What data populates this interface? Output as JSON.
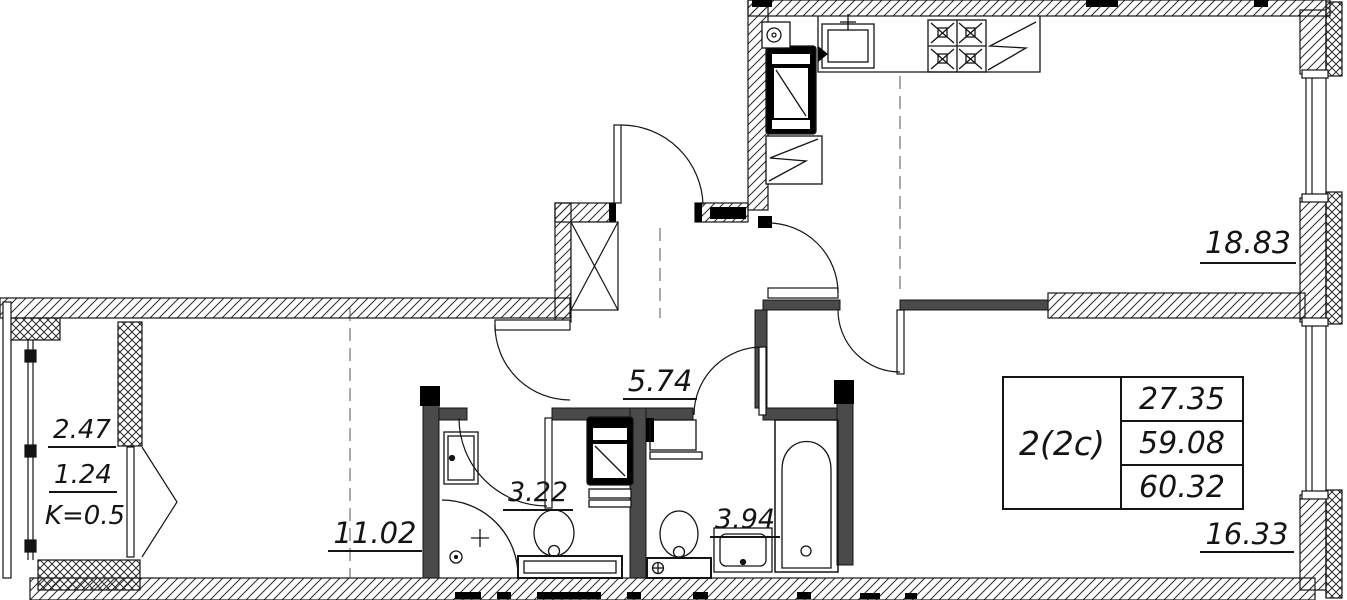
{
  "floorplan": {
    "rooms": {
      "kitchen_living_area": "18.83",
      "hall_area": "5.74",
      "bedroom_area": "11.02",
      "bathroom_area": "3.22",
      "wc_area": "3.94",
      "living_room_area": "16.33"
    },
    "balcony": {
      "full_area": "2.47",
      "counted_area": "1.24",
      "coefficient": "K=0.5"
    },
    "info_table": {
      "unit_type": "2(2c)",
      "living_area": "27.35",
      "floor_area": "59.08",
      "total_area": "60.32"
    },
    "colors": {
      "line": "#1a1a1a",
      "background": "#ffffff"
    }
  }
}
